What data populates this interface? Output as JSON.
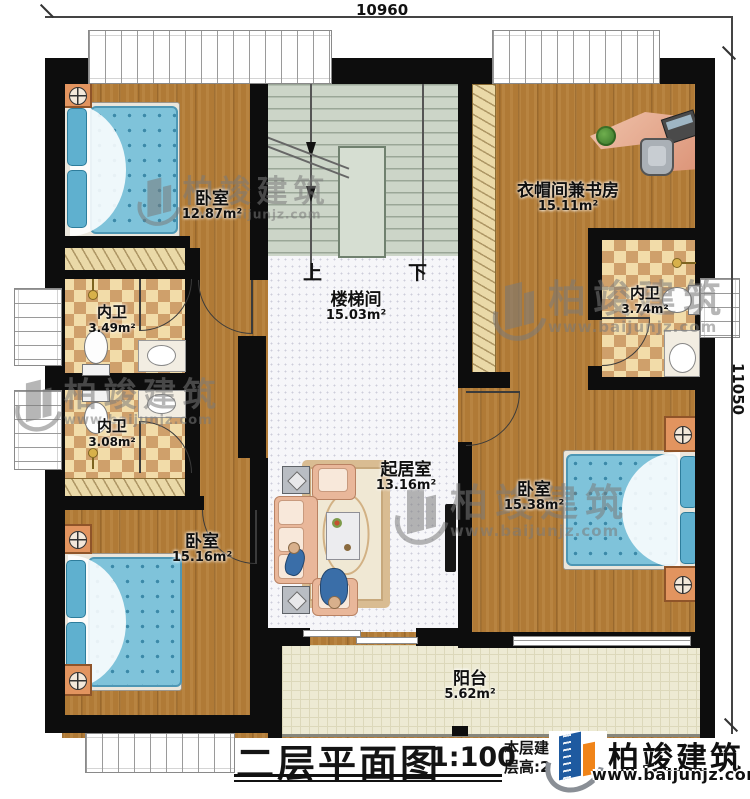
{
  "title_block": {
    "title": "二层平面图",
    "scale": "1:100",
    "note_line1": "本层建筑面积:",
    "note_line2": "层高:2.9m"
  },
  "dimensions": {
    "top": "10960",
    "right": "11050"
  },
  "rooms": {
    "bedroom_tl": {
      "name": "卧室",
      "area": "12.87m²"
    },
    "study": {
      "name": "衣帽间兼书房",
      "area": "15.11m²"
    },
    "stairwell": {
      "name": "楼梯间",
      "area": "15.03m²"
    },
    "bath1": {
      "name": "内卫",
      "area": "3.49m²"
    },
    "bath2": {
      "name": "内卫",
      "area": "3.08m²"
    },
    "bath3": {
      "name": "内卫",
      "area": "3.74m²"
    },
    "living": {
      "name": "起居室",
      "area": "13.16m²"
    },
    "bedroom_br": {
      "name": "卧室",
      "area": "15.38m²"
    },
    "bedroom_bl": {
      "name": "卧室",
      "area": "15.16m²"
    },
    "balcony": {
      "name": "阳台",
      "area": "5.62m²"
    }
  },
  "stairs": {
    "up": "上",
    "down": "下"
  },
  "brand": {
    "name": "柏竣建筑",
    "website": "www.baijunjz.com"
  },
  "watermark": {
    "name": "柏竣建筑",
    "website": "www.baijunjz.com"
  },
  "icons": {
    "brand_logo": "building-with-swoosh",
    "watermark_logo": "building-with-swoosh",
    "cabinet_handle": "circle-cross",
    "ceiling_lamp": "gold-circle"
  },
  "colors": {
    "brand_blue": "#1e5aa0",
    "brand_orange": "#f08419",
    "wall": "#0d0d0d",
    "wood_floor": "#b07a36",
    "stair_floor": "#ccd5c8",
    "bath_tile": "#f2dca9",
    "balcony_tile": "#edead3",
    "bed_fabric": "#7fc3da",
    "sofa_fabric": "#e9b79a"
  }
}
